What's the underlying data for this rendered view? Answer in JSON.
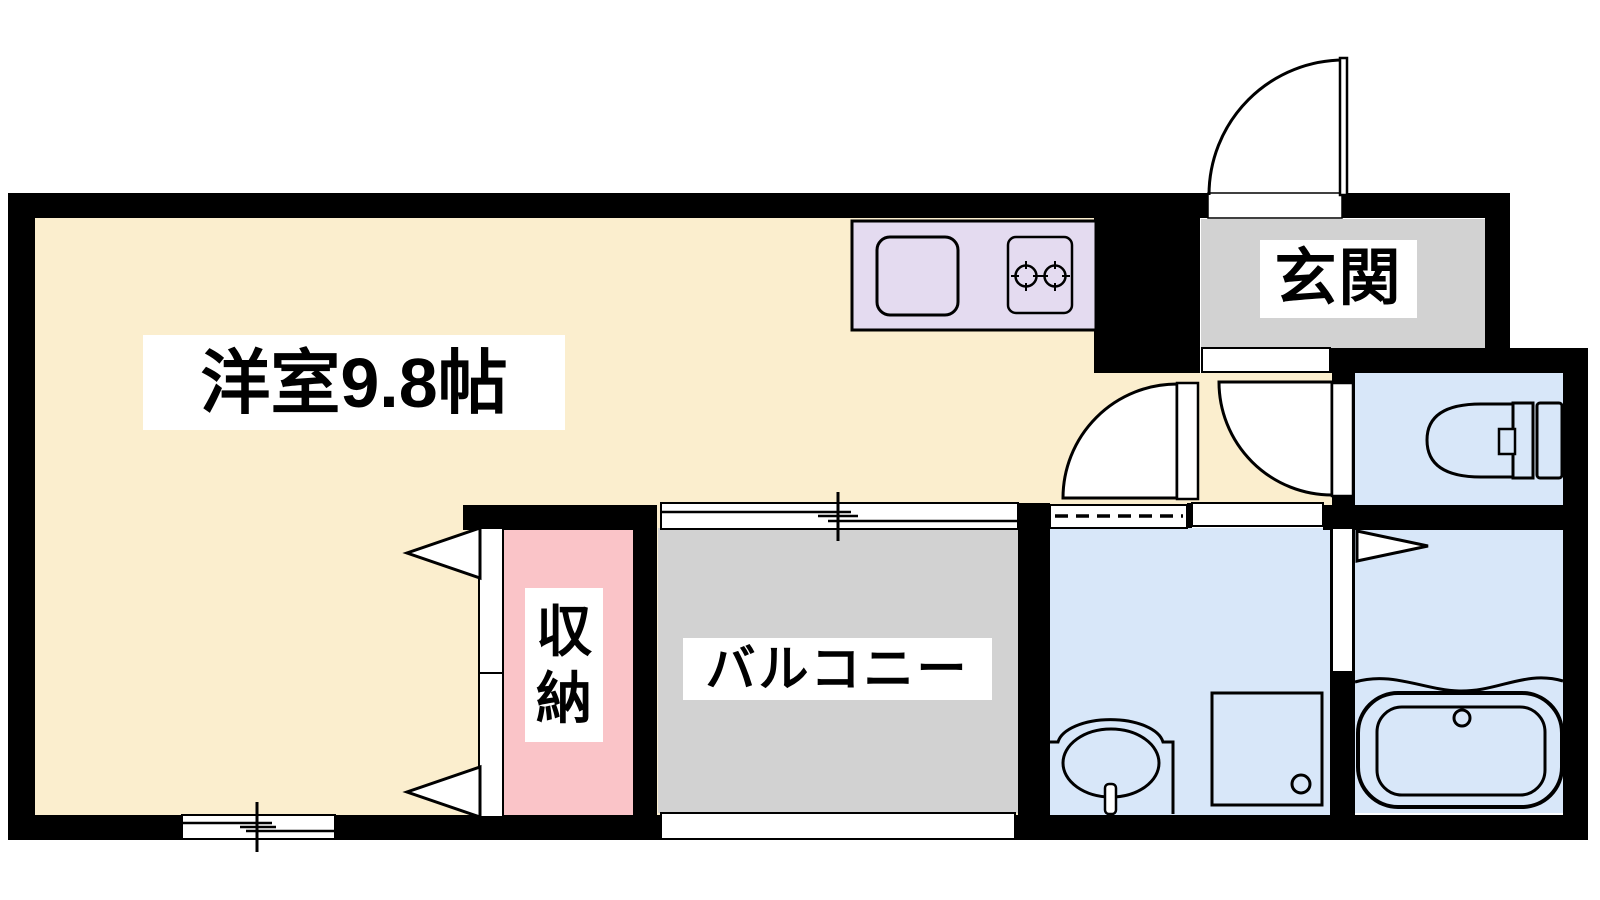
{
  "plan": {
    "type": "floor-plan",
    "rooms": {
      "main": {
        "label": "洋室9.8帖"
      },
      "entrance": {
        "label": "玄関"
      },
      "closet": {
        "label_line1": "収",
        "label_line2": "納",
        "label": "収納"
      },
      "balcony": {
        "label": "バルコニー"
      }
    },
    "unlabeled_areas": [
      "kitchen",
      "toilet",
      "washroom",
      "bathroom",
      "hallway"
    ],
    "icons": [
      "kitchen-sink-icon",
      "stove-burners-icon",
      "entry-door-swing-icon",
      "interior-door-swing-icon",
      "toilet-icon",
      "washbasin-icon",
      "washer-pan-icon",
      "bathtub-icon",
      "sliding-window-icon",
      "folding-door-triangle-icon"
    ]
  },
  "colors": {
    "room": "#FBEECE",
    "entrance": "#D2D2D2",
    "balcony": "#D2D2D2",
    "closet": "#FAC4C8",
    "water": "#D8E7F9",
    "kitchen": "#E4DBF0",
    "wall": "#000000",
    "line": "#000000",
    "paper": "#FFFFFF"
  }
}
